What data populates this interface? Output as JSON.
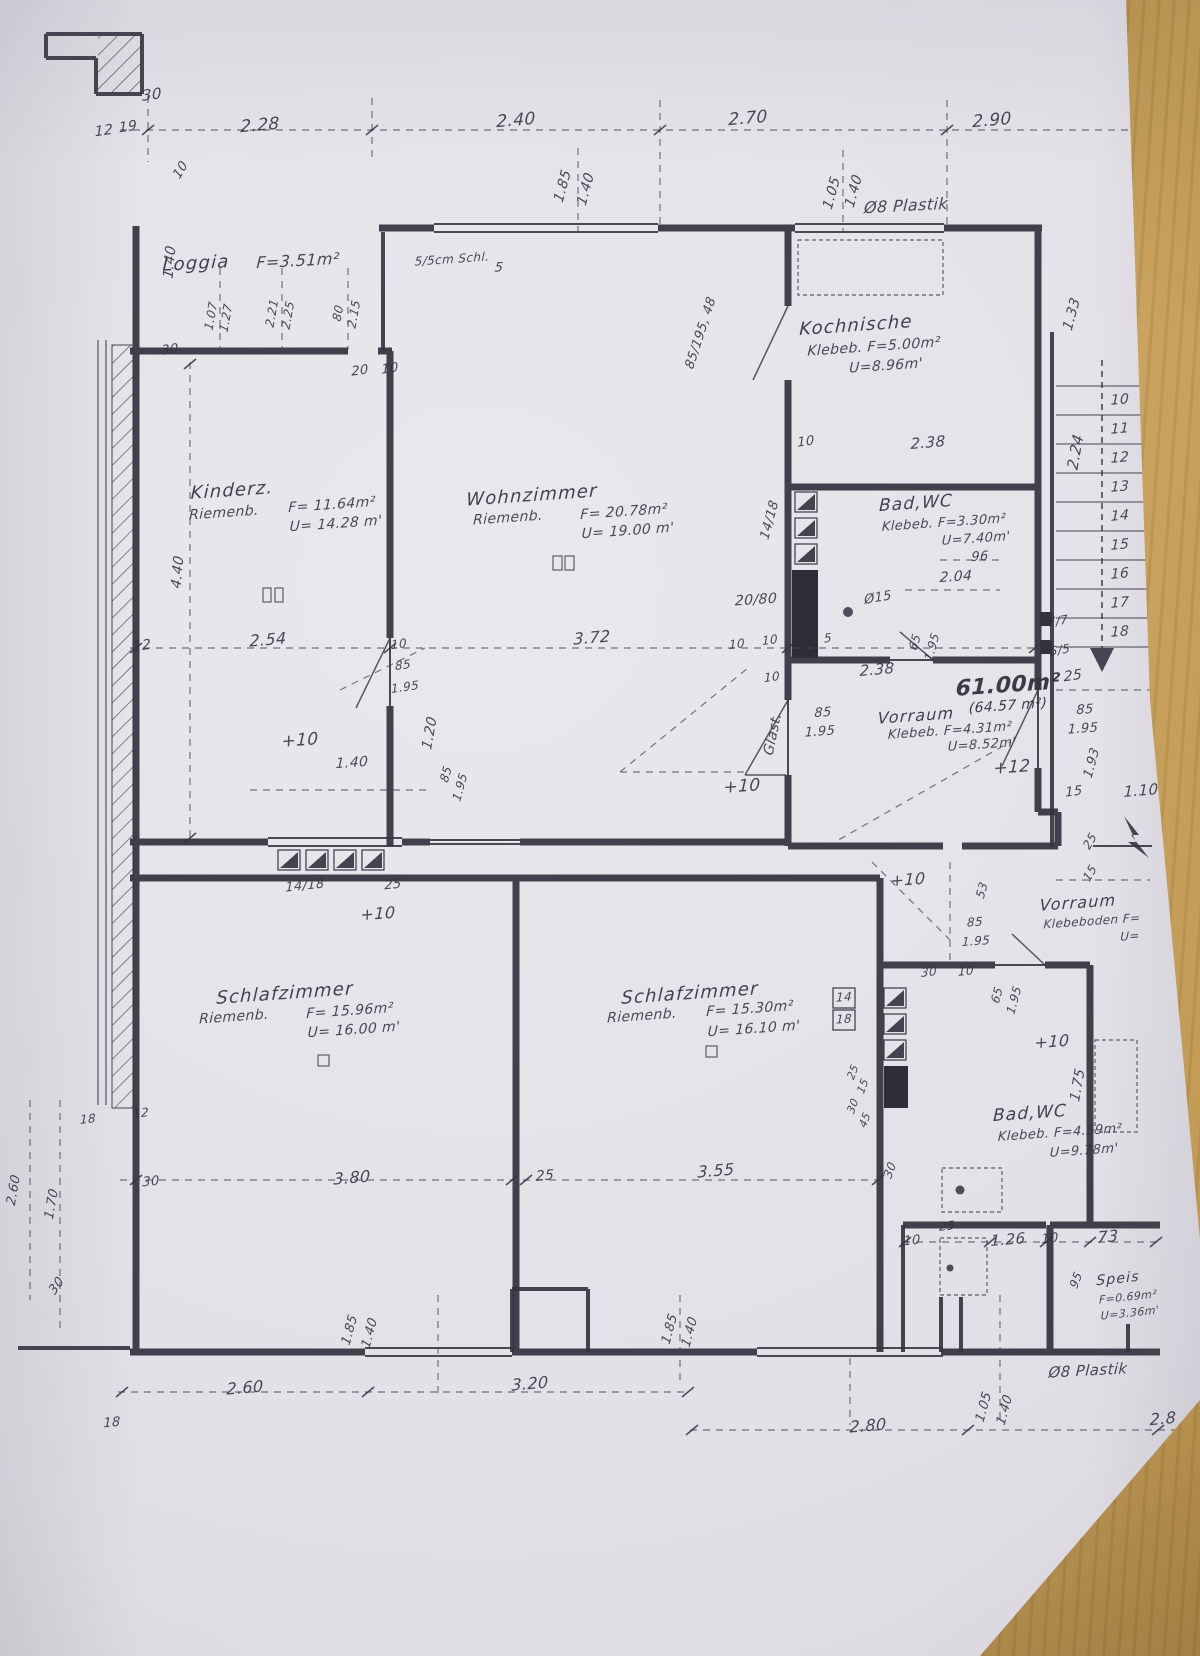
{
  "meta": {
    "kind": "scanned floor plan drawing",
    "language": "de"
  },
  "colors": {
    "ink": "#33323f",
    "paper": "#e6e4e9",
    "wood": "#b8924e"
  },
  "summary": {
    "total_area": "61.00m²",
    "total_area_alt": "(64.57 m²)",
    "rooms": [
      {
        "name": "Loggia",
        "f": "3.51m²"
      },
      {
        "name": "Kinderz.",
        "floor": "Riemenb.",
        "f": "11.64m²",
        "u": "14.28 m"
      },
      {
        "name": "Wohnzimmer",
        "floor": "Riemenb.",
        "f": "20.78m²",
        "u": "19.00 m"
      },
      {
        "name": "Kochnische",
        "floor": "Klebeb.",
        "f": "5.00m²",
        "u": "8.96m"
      },
      {
        "name": "Bad,WC",
        "floor": "Klebeb.",
        "f": "3.30m²",
        "u": "7.40m"
      },
      {
        "name": "Vorraum",
        "floor": "Klebeb.",
        "f": "4.31m²",
        "u": "8.52m"
      },
      {
        "name": "Schlafzimmer",
        "floor": "Riemenb.",
        "f": "15.96m²",
        "u": "16.00 m"
      },
      {
        "name": "Schlafzimmer",
        "floor": "Riemenb.",
        "f": "15.30m²",
        "u": "16.10 m"
      },
      {
        "name": "Bad,WC",
        "floor": "Klebeb.",
        "f": "4.59m²",
        "u": "9.78m"
      },
      {
        "name": "Speis",
        "f": "0.69m²",
        "u": "3.36m"
      },
      {
        "name": "Vorraum",
        "floor": "Klebeboden"
      }
    ]
  },
  "annotations": [
    {
      "t": "30",
      "x": 152,
      "y": 95,
      "r": -8,
      "s": 15
    },
    {
      "t": "12",
      "x": 104,
      "y": 131,
      "r": -8,
      "s": 14
    },
    {
      "t": "19",
      "x": 128,
      "y": 127,
      "r": -8,
      "s": 14
    },
    {
      "t": "2.28",
      "x": 260,
      "y": 126,
      "r": -5,
      "s": 17
    },
    {
      "t": "2.40",
      "x": 516,
      "y": 121,
      "r": -5,
      "s": 17
    },
    {
      "t": "2.70",
      "x": 748,
      "y": 119,
      "r": -5,
      "s": 17
    },
    {
      "t": "2.90",
      "x": 992,
      "y": 121,
      "r": -5,
      "s": 17
    },
    {
      "t": "1.85",
      "x": 563,
      "y": 186,
      "r": -75,
      "s": 14
    },
    {
      "t": "1.40",
      "x": 586,
      "y": 189,
      "r": -75,
      "s": 14
    },
    {
      "t": "1.05",
      "x": 832,
      "y": 193,
      "r": -75,
      "s": 14
    },
    {
      "t": "1.40",
      "x": 854,
      "y": 191,
      "r": -75,
      "s": 14
    },
    {
      "t": "Ø8 Plastik",
      "x": 906,
      "y": 206,
      "r": -3,
      "s": 16,
      "k": "note"
    },
    {
      "t": "10",
      "x": 181,
      "y": 170,
      "r": -60,
      "s": 13
    },
    {
      "t": "1.40",
      "x": 170,
      "y": 262,
      "r": -85,
      "s": 14
    },
    {
      "t": "Loggia",
      "x": 196,
      "y": 264,
      "r": -3,
      "s": 18,
      "k": "room-name"
    },
    {
      "t": "F=3.51m²",
      "x": 298,
      "y": 261,
      "r": -3,
      "s": 16,
      "k": "room-spec"
    },
    {
      "t": "5/5cm Schl.",
      "x": 452,
      "y": 259,
      "r": -4,
      "s": 12,
      "k": "note"
    },
    {
      "t": "5",
      "x": 499,
      "y": 268,
      "r": 0,
      "s": 13
    },
    {
      "t": "1.07",
      "x": 211,
      "y": 316,
      "r": -80,
      "s": 12
    },
    {
      "t": "1.27",
      "x": 226,
      "y": 318,
      "r": -80,
      "s": 12
    },
    {
      "t": "2.21",
      "x": 272,
      "y": 313,
      "r": -80,
      "s": 12
    },
    {
      "t": "2.25",
      "x": 288,
      "y": 315,
      "r": -80,
      "s": 12
    },
    {
      "t": "80",
      "x": 338,
      "y": 313,
      "r": -80,
      "s": 12
    },
    {
      "t": "2.15",
      "x": 354,
      "y": 314,
      "r": -80,
      "s": 12
    },
    {
      "t": "30",
      "x": 170,
      "y": 350,
      "r": -8,
      "s": 13
    },
    {
      "t": "20",
      "x": 360,
      "y": 371,
      "r": -8,
      "s": 13
    },
    {
      "t": "10",
      "x": 390,
      "y": 369,
      "r": -8,
      "s": 13
    },
    {
      "t": "85/195, 48",
      "x": 701,
      "y": 333,
      "r": -72,
      "s": 13
    },
    {
      "t": "Kochnische",
      "x": 856,
      "y": 326,
      "r": -4,
      "s": 18,
      "k": "room-name"
    },
    {
      "t": "Klebeb. F=5.00m²",
      "x": 874,
      "y": 347,
      "r": -4,
      "s": 14,
      "k": "room-spec"
    },
    {
      "t": "U=8.96m'",
      "x": 886,
      "y": 366,
      "r": -4,
      "s": 14,
      "k": "room-spec"
    },
    {
      "t": "1.33",
      "x": 1072,
      "y": 314,
      "r": -75,
      "s": 14
    },
    {
      "t": "10",
      "x": 1120,
      "y": 400,
      "r": -5,
      "s": 14,
      "k": "stair-step"
    },
    {
      "t": "11",
      "x": 1120,
      "y": 429,
      "r": -5,
      "s": 14,
      "k": "stair-step"
    },
    {
      "t": "12",
      "x": 1120,
      "y": 458,
      "r": -5,
      "s": 14,
      "k": "stair-step"
    },
    {
      "t": "13",
      "x": 1120,
      "y": 487,
      "r": -5,
      "s": 14,
      "k": "stair-step"
    },
    {
      "t": "14",
      "x": 1120,
      "y": 516,
      "r": -5,
      "s": 14,
      "k": "stair-step"
    },
    {
      "t": "15",
      "x": 1120,
      "y": 545,
      "r": -5,
      "s": 14,
      "k": "stair-step"
    },
    {
      "t": "16",
      "x": 1120,
      "y": 574,
      "r": -5,
      "s": 14,
      "k": "stair-step"
    },
    {
      "t": "17",
      "x": 1120,
      "y": 603,
      "r": -5,
      "s": 14,
      "k": "stair-step"
    },
    {
      "t": "18",
      "x": 1120,
      "y": 632,
      "r": -5,
      "s": 14,
      "k": "stair-step"
    },
    {
      "t": "2.24",
      "x": 1076,
      "y": 452,
      "r": -80,
      "s": 15
    },
    {
      "t": "10",
      "x": 806,
      "y": 442,
      "r": -8,
      "s": 13
    },
    {
      "t": "2.38",
      "x": 928,
      "y": 443,
      "r": -5,
      "s": 15
    },
    {
      "t": "Kinderz.",
      "x": 232,
      "y": 491,
      "r": -4,
      "s": 18,
      "k": "room-name"
    },
    {
      "t": "Riemenb.",
      "x": 224,
      "y": 513,
      "r": -4,
      "s": 14,
      "k": "room-spec"
    },
    {
      "t": "F= 11.64m²",
      "x": 332,
      "y": 505,
      "r": -4,
      "s": 14,
      "k": "room-spec"
    },
    {
      "t": "U= 14.28 m'",
      "x": 336,
      "y": 524,
      "r": -4,
      "s": 14,
      "k": "room-spec"
    },
    {
      "t": "4.40",
      "x": 178,
      "y": 572,
      "r": -85,
      "s": 14
    },
    {
      "t": "Wohnzimmer",
      "x": 532,
      "y": 496,
      "r": -4,
      "s": 18,
      "k": "room-name"
    },
    {
      "t": "Riemenb.",
      "x": 508,
      "y": 518,
      "r": -4,
      "s": 14,
      "k": "room-spec"
    },
    {
      "t": "F= 20.78m²",
      "x": 624,
      "y": 512,
      "r": -4,
      "s": 14,
      "k": "room-spec"
    },
    {
      "t": "U= 19.00 m'",
      "x": 628,
      "y": 531,
      "r": -4,
      "s": 14,
      "k": "room-spec"
    },
    {
      "t": "12",
      "x": 142,
      "y": 646,
      "r": -8,
      "s": 14
    },
    {
      "t": "2.54",
      "x": 268,
      "y": 640,
      "r": -5,
      "s": 16
    },
    {
      "t": "10",
      "x": 399,
      "y": 644,
      "r": -8,
      "s": 12
    },
    {
      "t": "85",
      "x": 403,
      "y": 665,
      "r": -8,
      "s": 12
    },
    {
      "t": "1.95",
      "x": 405,
      "y": 687,
      "r": -8,
      "s": 12
    },
    {
      "t": "3.72",
      "x": 592,
      "y": 638,
      "r": -5,
      "s": 16
    },
    {
      "t": "10",
      "x": 737,
      "y": 644,
      "r": -8,
      "s": 12
    },
    {
      "t": "14/18",
      "x": 770,
      "y": 520,
      "r": -75,
      "s": 13
    },
    {
      "t": "Bad,WC",
      "x": 916,
      "y": 504,
      "r": -4,
      "s": 17,
      "k": "room-name"
    },
    {
      "t": "Klebeb. F=3.30m²",
      "x": 944,
      "y": 523,
      "r": -4,
      "s": 13,
      "k": "room-spec"
    },
    {
      "t": "U=7.40m'",
      "x": 976,
      "y": 539,
      "r": -4,
      "s": 13,
      "k": "room-spec"
    },
    {
      "t": "96",
      "x": 980,
      "y": 557,
      "r": -4,
      "s": 13
    },
    {
      "t": "2.04",
      "x": 956,
      "y": 577,
      "r": -4,
      "s": 14
    },
    {
      "t": "20/80",
      "x": 756,
      "y": 600,
      "r": -4,
      "s": 14
    },
    {
      "t": "Ø15",
      "x": 878,
      "y": 598,
      "r": -10,
      "s": 13
    },
    {
      "t": "10",
      "x": 770,
      "y": 640,
      "r": -8,
      "s": 12
    },
    {
      "t": "5",
      "x": 828,
      "y": 638,
      "r": -8,
      "s": 12
    },
    {
      "t": "65",
      "x": 915,
      "y": 642,
      "r": -75,
      "s": 12
    },
    {
      "t": "1.95",
      "x": 932,
      "y": 647,
      "r": -75,
      "s": 12
    },
    {
      "t": "10",
      "x": 772,
      "y": 677,
      "r": -8,
      "s": 12
    },
    {
      "t": "2.38",
      "x": 877,
      "y": 670,
      "r": -5,
      "s": 15
    },
    {
      "t": "61.00m²",
      "x": 1008,
      "y": 686,
      "r": -4,
      "s": 22,
      "w": 1,
      "k": "total-area"
    },
    {
      "t": "(64.57 m²)",
      "x": 1008,
      "y": 706,
      "r": -4,
      "s": 14,
      "k": "total-area"
    },
    {
      "t": "Glast.",
      "x": 773,
      "y": 734,
      "r": -78,
      "s": 14,
      "k": "note"
    },
    {
      "t": "85",
      "x": 823,
      "y": 713,
      "r": -4,
      "s": 13
    },
    {
      "t": "1.95",
      "x": 820,
      "y": 732,
      "r": -4,
      "s": 13
    },
    {
      "t": "Vorraum",
      "x": 916,
      "y": 716,
      "r": -4,
      "s": 16,
      "k": "room-name"
    },
    {
      "t": "Klebeb. F=4.31m²",
      "x": 950,
      "y": 731,
      "r": -4,
      "s": 13,
      "k": "room-spec"
    },
    {
      "t": "U=8.52m'",
      "x": 982,
      "y": 745,
      "r": -4,
      "s": 13,
      "k": "room-spec"
    },
    {
      "t": "85",
      "x": 1085,
      "y": 710,
      "r": -4,
      "s": 13
    },
    {
      "t": "1.95",
      "x": 1083,
      "y": 729,
      "r": -4,
      "s": 13
    },
    {
      "t": "1.93",
      "x": 1092,
      "y": 763,
      "r": -75,
      "s": 13
    },
    {
      "t": "15",
      "x": 1074,
      "y": 792,
      "r": -8,
      "s": 13
    },
    {
      "t": "1.10",
      "x": 1141,
      "y": 791,
      "r": -5,
      "s": 15
    },
    {
      "t": "+12",
      "x": 1012,
      "y": 768,
      "r": -4,
      "s": 17,
      "k": "level-mark"
    },
    {
      "t": "+10",
      "x": 742,
      "y": 787,
      "r": -4,
      "s": 17,
      "k": "level-mark"
    },
    {
      "t": "25",
      "x": 1090,
      "y": 841,
      "r": -60,
      "s": 12
    },
    {
      "t": "15",
      "x": 1090,
      "y": 873,
      "r": -60,
      "s": 12
    },
    {
      "t": "+10",
      "x": 300,
      "y": 741,
      "r": -4,
      "s": 17,
      "k": "level-mark"
    },
    {
      "t": "1.40",
      "x": 352,
      "y": 763,
      "r": -4,
      "s": 14
    },
    {
      "t": "1.20",
      "x": 430,
      "y": 733,
      "r": -80,
      "s": 14
    },
    {
      "t": "85",
      "x": 446,
      "y": 774,
      "r": -75,
      "s": 12
    },
    {
      "t": "1.95",
      "x": 460,
      "y": 787,
      "r": -75,
      "s": 12
    },
    {
      "t": "14/18",
      "x": 305,
      "y": 886,
      "r": -6,
      "s": 13
    },
    {
      "t": "25",
      "x": 393,
      "y": 885,
      "r": -6,
      "s": 13
    },
    {
      "t": "+10",
      "x": 378,
      "y": 914,
      "r": -4,
      "s": 16,
      "k": "level-mark"
    },
    {
      "t": "+10",
      "x": 908,
      "y": 880,
      "r": -4,
      "s": 16,
      "k": "level-mark"
    },
    {
      "t": "53",
      "x": 982,
      "y": 890,
      "r": -75,
      "s": 12
    },
    {
      "t": "85",
      "x": 975,
      "y": 922,
      "r": -4,
      "s": 12
    },
    {
      "t": "1.95",
      "x": 976,
      "y": 941,
      "r": -4,
      "s": 12
    },
    {
      "t": "30",
      "x": 929,
      "y": 972,
      "r": -6,
      "s": 12
    },
    {
      "t": "10",
      "x": 966,
      "y": 971,
      "r": -6,
      "s": 12
    },
    {
      "t": "65",
      "x": 997,
      "y": 995,
      "r": -75,
      "s": 12
    },
    {
      "t": "1.95",
      "x": 1014,
      "y": 1000,
      "r": -75,
      "s": 12
    },
    {
      "t": "Vorraum",
      "x": 1078,
      "y": 903,
      "r": -4,
      "s": 16,
      "k": "room-name"
    },
    {
      "t": "Klebeboden F=",
      "x": 1092,
      "y": 921,
      "r": -4,
      "s": 12,
      "k": "room-spec"
    },
    {
      "t": "U=",
      "x": 1130,
      "y": 936,
      "r": -4,
      "s": 12,
      "k": "room-spec"
    },
    {
      "t": "Schlafzimmer",
      "x": 285,
      "y": 994,
      "r": -4,
      "s": 18,
      "k": "room-name"
    },
    {
      "t": "Riemenb.",
      "x": 234,
      "y": 1017,
      "r": -4,
      "s": 14,
      "k": "room-spec"
    },
    {
      "t": "F= 15.96m²",
      "x": 350,
      "y": 1011,
      "r": -4,
      "s": 14,
      "k": "room-spec"
    },
    {
      "t": "U= 16.00 m'",
      "x": 354,
      "y": 1030,
      "r": -4,
      "s": 14,
      "k": "room-spec"
    },
    {
      "t": "Schlafzimmer",
      "x": 690,
      "y": 994,
      "r": -4,
      "s": 18,
      "k": "room-name"
    },
    {
      "t": "Riemenb.",
      "x": 642,
      "y": 1016,
      "r": -4,
      "s": 14,
      "k": "room-spec"
    },
    {
      "t": "F= 15.30m²",
      "x": 750,
      "y": 1009,
      "r": -4,
      "s": 14,
      "k": "room-spec"
    },
    {
      "t": "U= 16.10 m'",
      "x": 754,
      "y": 1029,
      "r": -4,
      "s": 14,
      "k": "room-spec"
    },
    {
      "t": "14",
      "x": 844,
      "y": 997,
      "r": -4,
      "s": 12
    },
    {
      "t": "18",
      "x": 844,
      "y": 1019,
      "r": -4,
      "s": 12
    },
    {
      "t": "25",
      "x": 853,
      "y": 1072,
      "r": -70,
      "s": 11
    },
    {
      "t": "15",
      "x": 863,
      "y": 1086,
      "r": -70,
      "s": 11
    },
    {
      "t": "30",
      "x": 853,
      "y": 1106,
      "r": -70,
      "s": 11
    },
    {
      "t": "45",
      "x": 865,
      "y": 1120,
      "r": -70,
      "s": 11
    },
    {
      "t": "+10",
      "x": 1052,
      "y": 1042,
      "r": -4,
      "s": 16,
      "k": "level-mark"
    },
    {
      "t": "1.75",
      "x": 1078,
      "y": 1085,
      "r": -80,
      "s": 14
    },
    {
      "t": "Bad,WC",
      "x": 1030,
      "y": 1114,
      "r": -4,
      "s": 17,
      "k": "room-name"
    },
    {
      "t": "Klebeb. F=4.59m²",
      "x": 1060,
      "y": 1133,
      "r": -4,
      "s": 13,
      "k": "room-spec"
    },
    {
      "t": "U=9.78m'",
      "x": 1084,
      "y": 1151,
      "r": -4,
      "s": 13,
      "k": "room-spec"
    },
    {
      "t": "30",
      "x": 890,
      "y": 1170,
      "r": -70,
      "s": 12
    },
    {
      "t": "25",
      "x": 947,
      "y": 1226,
      "r": -6,
      "s": 12
    },
    {
      "t": "10",
      "x": 912,
      "y": 1241,
      "r": -6,
      "s": 13
    },
    {
      "t": "1.26",
      "x": 1008,
      "y": 1240,
      "r": -5,
      "s": 15
    },
    {
      "t": "10",
      "x": 1050,
      "y": 1239,
      "r": -6,
      "s": 13
    },
    {
      "t": "73",
      "x": 1108,
      "y": 1237,
      "r": -5,
      "s": 16
    },
    {
      "t": "95",
      "x": 1076,
      "y": 1280,
      "r": -70,
      "s": 12
    },
    {
      "t": "Speis",
      "x": 1118,
      "y": 1279,
      "r": -6,
      "s": 14,
      "k": "room-name"
    },
    {
      "t": "F=0.69m²",
      "x": 1128,
      "y": 1297,
      "r": -6,
      "s": 11,
      "k": "room-spec"
    },
    {
      "t": "U=3.36m'",
      "x": 1130,
      "y": 1313,
      "r": -6,
      "s": 11,
      "k": "room-spec"
    },
    {
      "t": "18",
      "x": 88,
      "y": 1119,
      "r": -6,
      "s": 12
    },
    {
      "t": "12",
      "x": 141,
      "y": 1113,
      "r": -6,
      "s": 12
    },
    {
      "t": "2.60",
      "x": 14,
      "y": 1190,
      "r": -80,
      "s": 13
    },
    {
      "t": "1.70",
      "x": 52,
      "y": 1204,
      "r": -80,
      "s": 13
    },
    {
      "t": "30",
      "x": 151,
      "y": 1182,
      "r": -6,
      "s": 13
    },
    {
      "t": "3.80",
      "x": 352,
      "y": 1178,
      "r": -5,
      "s": 16
    },
    {
      "t": "25",
      "x": 545,
      "y": 1176,
      "r": -5,
      "s": 14
    },
    {
      "t": "3.55",
      "x": 716,
      "y": 1171,
      "r": -5,
      "s": 16
    },
    {
      "t": "30",
      "x": 57,
      "y": 1286,
      "r": -55,
      "s": 13
    },
    {
      "t": "1.85",
      "x": 350,
      "y": 1330,
      "r": -75,
      "s": 13
    },
    {
      "t": "1.40",
      "x": 370,
      "y": 1333,
      "r": -75,
      "s": 13
    },
    {
      "t": "2.60",
      "x": 245,
      "y": 1388,
      "r": -5,
      "s": 16
    },
    {
      "t": "3.20",
      "x": 530,
      "y": 1384,
      "r": -5,
      "s": 16
    },
    {
      "t": "1.85",
      "x": 670,
      "y": 1329,
      "r": -75,
      "s": 13
    },
    {
      "t": "1.40",
      "x": 690,
      "y": 1332,
      "r": -75,
      "s": 13
    },
    {
      "t": "2.80",
      "x": 868,
      "y": 1426,
      "r": -5,
      "s": 16
    },
    {
      "t": "1.05",
      "x": 984,
      "y": 1407,
      "r": -75,
      "s": 13
    },
    {
      "t": "1.40",
      "x": 1005,
      "y": 1410,
      "r": -75,
      "s": 13
    },
    {
      "t": "Ø8 Plastik",
      "x": 1088,
      "y": 1371,
      "r": -3,
      "s": 15,
      "k": "note"
    },
    {
      "t": "2.8",
      "x": 1163,
      "y": 1419,
      "r": -5,
      "s": 16
    },
    {
      "t": "18",
      "x": 112,
      "y": 1423,
      "r": -6,
      "s": 13
    },
    {
      "t": "7/7",
      "x": 1058,
      "y": 621,
      "r": -10,
      "s": 12
    },
    {
      "t": "5/5",
      "x": 1060,
      "y": 650,
      "r": -10,
      "s": 12
    },
    {
      "t": "25",
      "x": 1073,
      "y": 676,
      "r": -8,
      "s": 14
    }
  ]
}
